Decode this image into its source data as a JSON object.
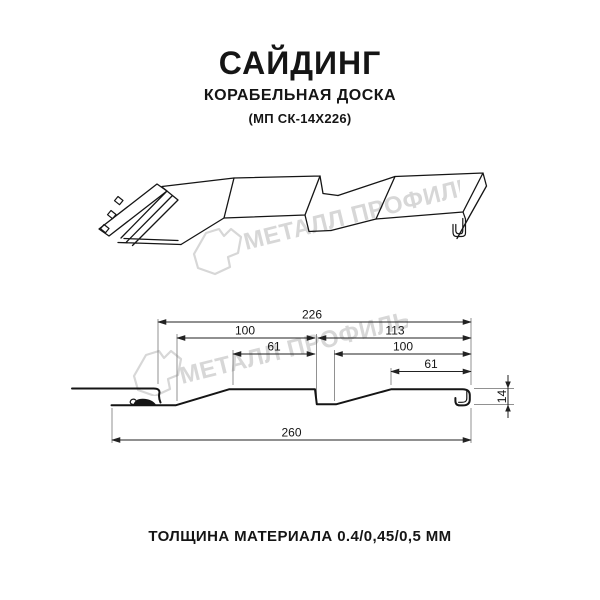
{
  "product": {
    "title": "САЙДИНГ",
    "subtitle": "КОРАБЕЛЬНАЯ ДОСКА",
    "model": "(МП СК-14Х226)"
  },
  "watermark": {
    "text": "МЕТАЛЛ ПРОФИЛЬ",
    "logo_icon": "metall-profil-logo",
    "color": "#d7d7d7"
  },
  "dimensions": {
    "total_top": "226",
    "left_module": "100",
    "right_module": "113",
    "left_flat": "61",
    "right_inner": "100",
    "right_flat": "61",
    "overall_bottom": "260",
    "profile_height": "14"
  },
  "footer": {
    "thickness_note": "ТОЛЩИНА МАТЕРИАЛА 0.4/0,45/0,5 ММ"
  },
  "colors": {
    "line": "#151515",
    "dimension": "#222222",
    "watermark": "#d7d7d7",
    "background": "#ffffff"
  }
}
